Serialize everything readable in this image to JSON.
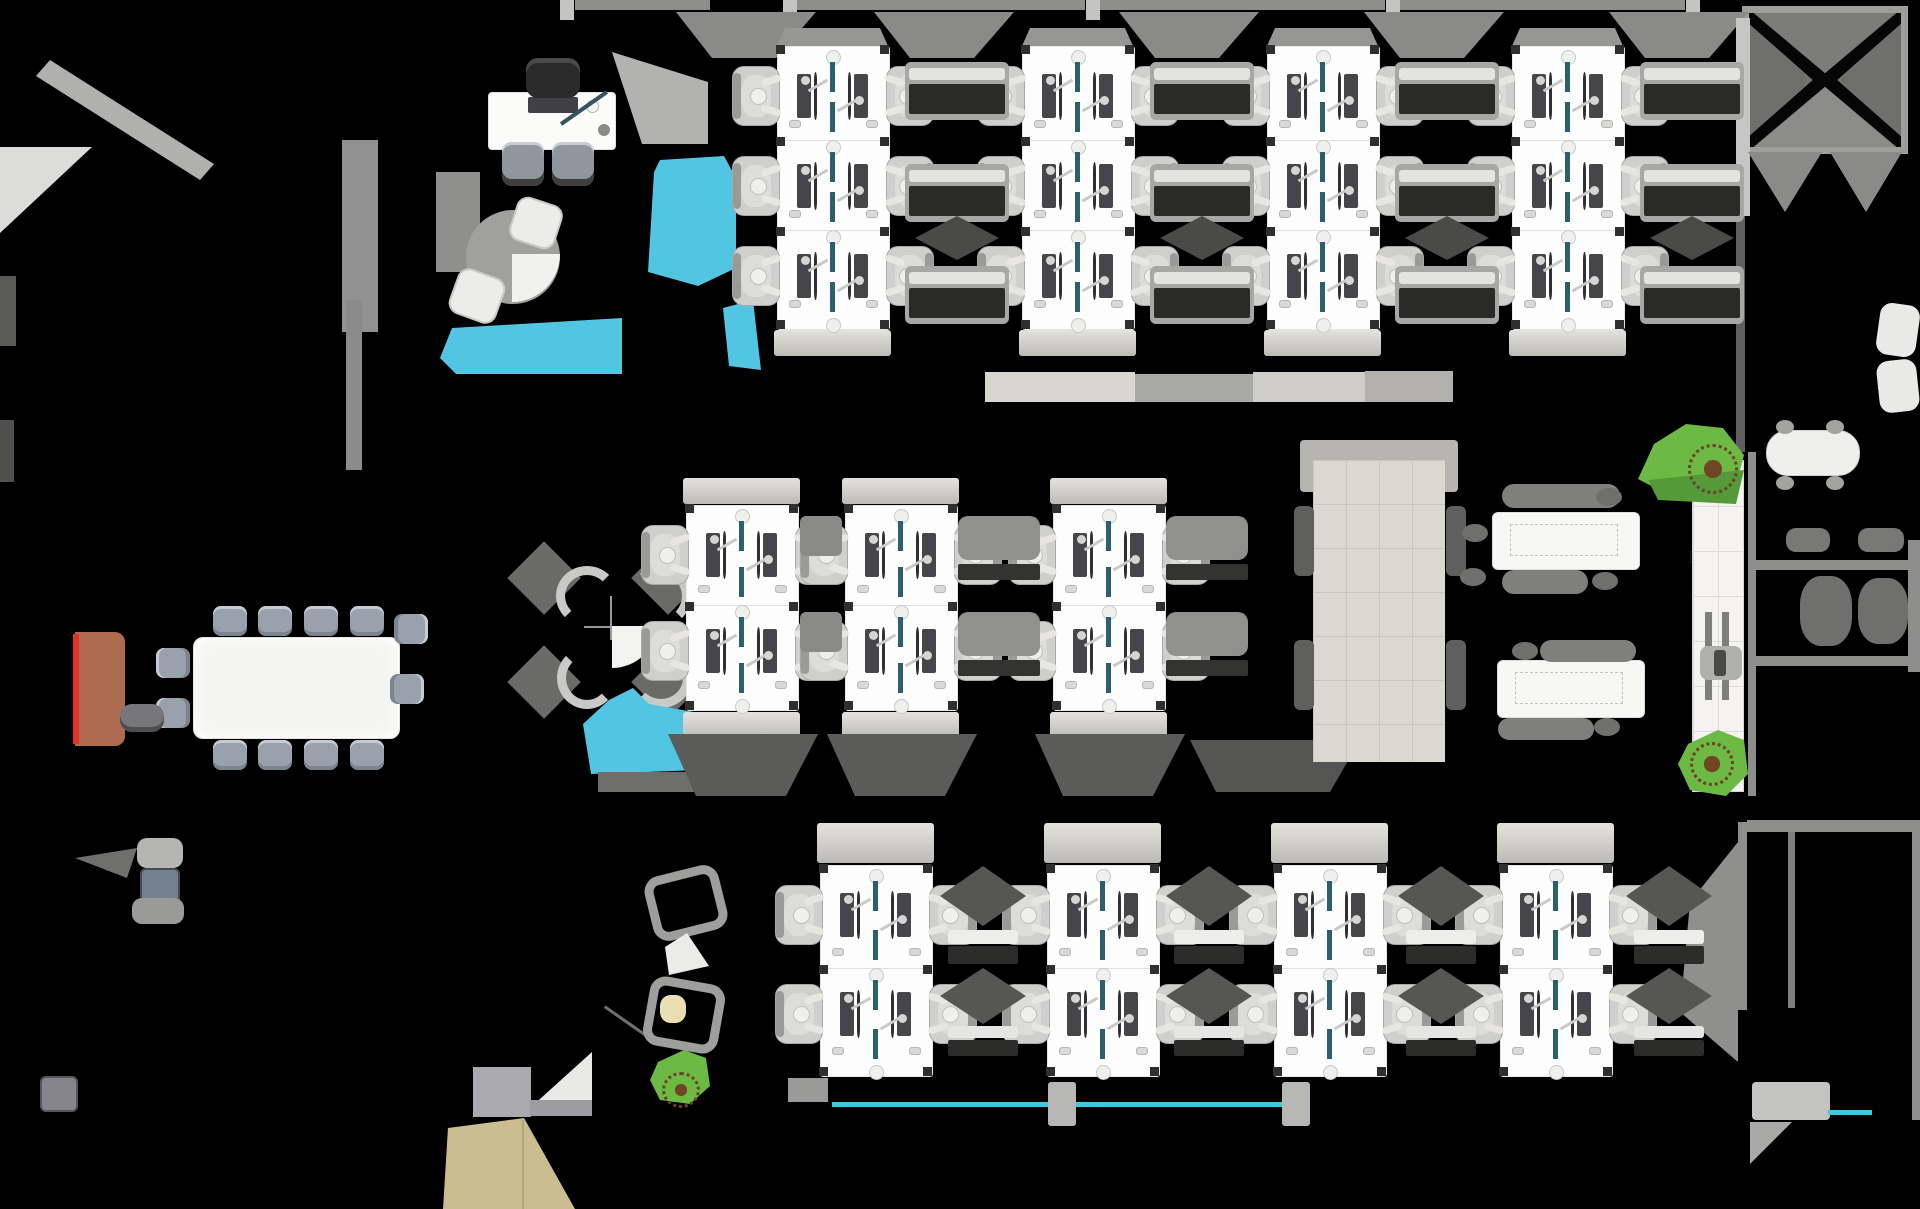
{
  "plan_title": "office floor plan",
  "labels": {
    "booths": [
      {
        "line1": "Booth Unit",
        "line2": "6 seater"
      },
      {
        "line1": "Booth Unit",
        "line2": "6 seater"
      }
    ],
    "pantry": {
      "fridge": "Fridge",
      "microwave": "M/W"
    }
  },
  "palette": {
    "background": "#000000",
    "benchWhite": "#fdfdfd",
    "cyan": "#52c5e2",
    "doorCyan": "#3ec9de",
    "boothGold": "#b49a55",
    "beige": "#dbd8d0",
    "green": "#6cb944",
    "greenDark": "#549a38",
    "credenzaBrown": "#ad6b50",
    "redStrip": "#e23127",
    "kiteBeige": "#cabe90",
    "deskTeal": "#2b5f6b",
    "wallGray": "#8e8e8c",
    "chairGray": "#cfcfcd",
    "conferenceChair": "#99a2ac"
  },
  "zones": {
    "booth_count": 2,
    "workbench_count": 11
  }
}
